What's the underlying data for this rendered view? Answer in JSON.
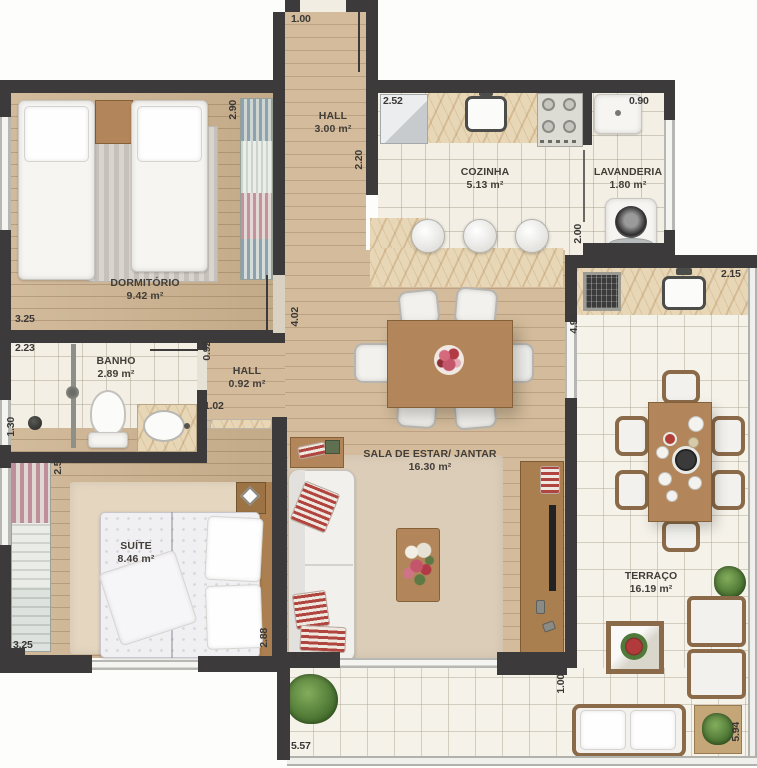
{
  "rooms": [
    {
      "id": "dormitorio",
      "name": "DORMITÓRIO",
      "area": "9.42 m²"
    },
    {
      "id": "hall",
      "name": "HALL",
      "area": "3.00 m²"
    },
    {
      "id": "cozinha",
      "name": "COZINHA",
      "area": "5.13 m²"
    },
    {
      "id": "lavanderia",
      "name": "LAVANDERIA",
      "area": "1.80 m²"
    },
    {
      "id": "banho",
      "name": "BANHO",
      "area": "2.89 m²"
    },
    {
      "id": "hall-pequeno",
      "name": "HALL",
      "area": "0.92 m²"
    },
    {
      "id": "sala",
      "name": "SALA DE ESTAR/ JANTAR",
      "area": "16.30 m²"
    },
    {
      "id": "suite",
      "name": "SUÍTE",
      "area": "8.46 m²"
    },
    {
      "id": "terraco",
      "name": "TERRAÇO",
      "area": "16.19 m²"
    }
  ],
  "dims": [
    "1.00",
    "2.90",
    "2.20",
    "2.52",
    "0.90",
    "2.00",
    "2.15",
    "4.94",
    "3.25",
    "4.02",
    "0.92",
    "2.23",
    "1.30",
    "1.02",
    "2.50",
    "3.25",
    "2.88",
    "3.30",
    "5.57",
    "1.00",
    "5.94"
  ],
  "colors": {
    "wall": "#3c3a3b",
    "wood_floor": "#cdb390",
    "tile_floor": "#f3efe4",
    "terrace_tile": "#f5f2e9",
    "marble": "#e8d7b6",
    "label_text": "#413d38",
    "plant_green": "#47702f",
    "accent_red": "#b0443e"
  },
  "furniture": [
    "twin-bed",
    "double-bed",
    "wardrobe",
    "fridge",
    "kitchen-sink",
    "stove",
    "laundry-tank",
    "washing-machine",
    "bar-stool",
    "shower",
    "toilet",
    "vanity-sink",
    "sofa",
    "coffee-table",
    "tv-rack",
    "dining-table",
    "dining-chair",
    "grill",
    "armchair",
    "side-table",
    "plant",
    "rug"
  ]
}
